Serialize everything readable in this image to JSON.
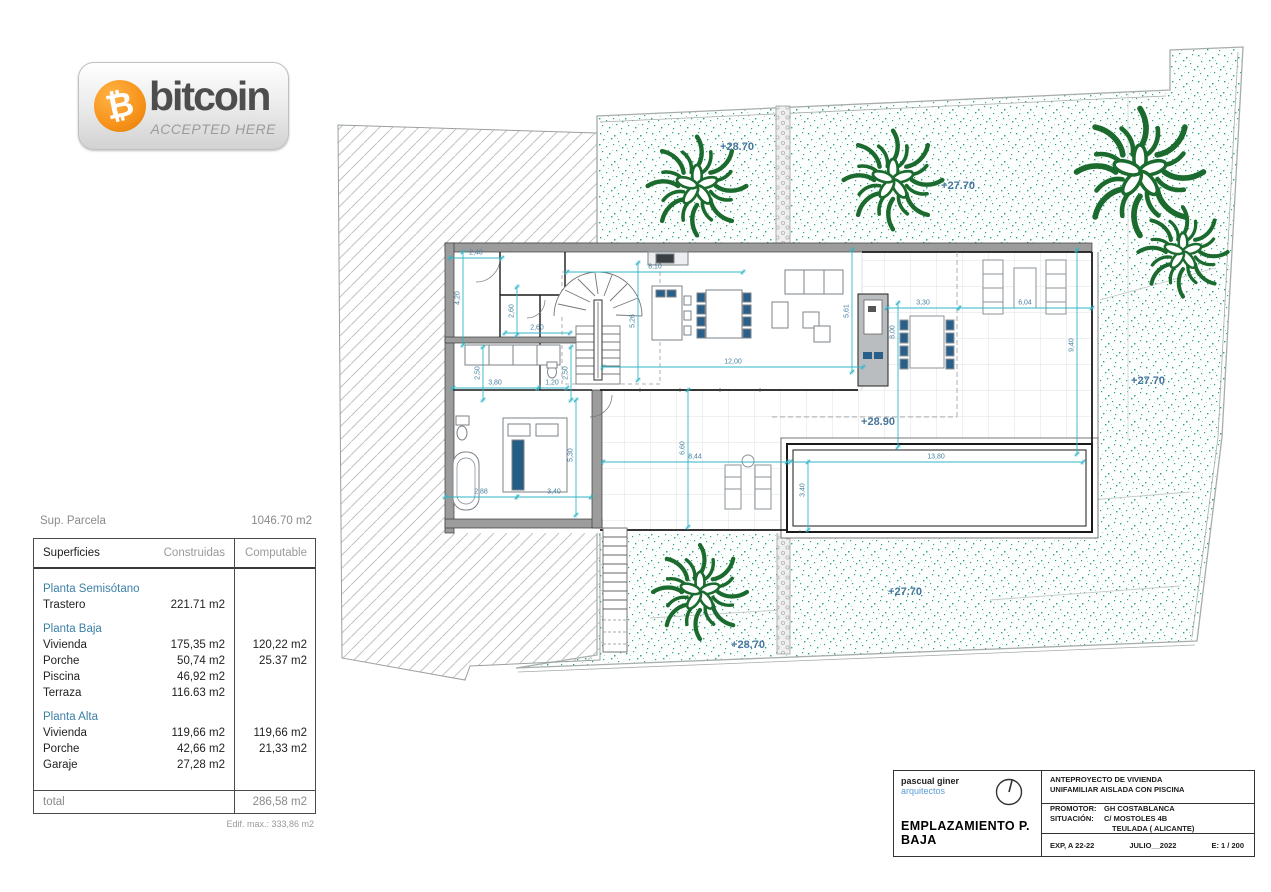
{
  "badge": {
    "symbol": "₿",
    "brand": "bitcoin",
    "tagline": "ACCEPTED HERE",
    "coin_color": "#f7931a"
  },
  "parcel_summary": {
    "label": "Sup. Parcela",
    "value": "1046.70 m2"
  },
  "area_table": {
    "headers": {
      "col1": "Superficies",
      "col2": "Construidas",
      "col3": "Computable"
    },
    "rows": [
      {
        "type": "section",
        "label": "Planta Semisótano",
        "built": "",
        "comp": ""
      },
      {
        "type": "item",
        "label": "Trastero",
        "built": "221.71 m2",
        "comp": ""
      },
      {
        "type": "section",
        "label": "Planta Baja",
        "built": "",
        "comp": ""
      },
      {
        "type": "item",
        "label": "Vivienda",
        "built": "175,35 m2",
        "comp": "120,22 m2"
      },
      {
        "type": "item",
        "label": "Porche",
        "built": "50,74 m2",
        "comp": "25.37 m2"
      },
      {
        "type": "item",
        "label": "Piscina",
        "built": "46,92 m2",
        "comp": ""
      },
      {
        "type": "item",
        "label": "Terraza",
        "built": "116.63 m2",
        "comp": ""
      },
      {
        "type": "section",
        "label": "Planta Alta",
        "built": "",
        "comp": ""
      },
      {
        "type": "item",
        "label": "Vivienda",
        "built": "119,66 m2",
        "comp": "119,66 m2"
      },
      {
        "type": "item",
        "label": "Porche",
        "built": "42,66 m2",
        "comp": "21,33 m2"
      },
      {
        "type": "item",
        "label": "Garaje",
        "built": "27,28 m2",
        "comp": ""
      }
    ],
    "total": {
      "label": "total",
      "value": "286,58 m2"
    },
    "footnote": "Edif. max.: 333,86 m2"
  },
  "plan": {
    "elevations": [
      {
        "text": "+28.70",
        "x": 737,
        "y": 147
      },
      {
        "text": "+27.70",
        "x": 958,
        "y": 186
      },
      {
        "text": "+27.70",
        "x": 1148,
        "y": 381
      },
      {
        "text": "+28.90",
        "x": 878,
        "y": 422
      },
      {
        "text": "+27.70",
        "x": 905,
        "y": 592
      },
      {
        "text": "+28.70",
        "x": 748,
        "y": 645
      }
    ],
    "dimensions": [
      {
        "text": "2,40",
        "x": 476,
        "y": 253,
        "rot": 0
      },
      {
        "text": "8,10",
        "x": 655,
        "y": 267,
        "rot": 0
      },
      {
        "text": "2,60",
        "x": 537,
        "y": 328,
        "rot": 0
      },
      {
        "text": "12,00",
        "x": 733,
        "y": 362,
        "rot": 0
      },
      {
        "text": "3,80",
        "x": 495,
        "y": 383,
        "rot": 0
      },
      {
        "text": "1,20",
        "x": 552,
        "y": 383,
        "rot": 0
      },
      {
        "text": "3,30",
        "x": 923,
        "y": 303,
        "rot": 0
      },
      {
        "text": "6,04",
        "x": 1025,
        "y": 303,
        "rot": 0
      },
      {
        "text": "8,44",
        "x": 695,
        "y": 457,
        "rot": 0
      },
      {
        "text": "13,80",
        "x": 936,
        "y": 457,
        "rot": 0
      },
      {
        "text": "2,88",
        "x": 481,
        "y": 492,
        "rot": 0
      },
      {
        "text": "3,40",
        "x": 554,
        "y": 492,
        "rot": 0
      },
      {
        "text": "4,20",
        "x": 458,
        "y": 298,
        "rot": 1
      },
      {
        "text": "2,60",
        "x": 512,
        "y": 311,
        "rot": 1
      },
      {
        "text": "5,26",
        "x": 633,
        "y": 321,
        "rot": 1
      },
      {
        "text": "2,50",
        "x": 478,
        "y": 373,
        "rot": 1
      },
      {
        "text": "2,50",
        "x": 566,
        "y": 373,
        "rot": 1
      },
      {
        "text": "5,61",
        "x": 847,
        "y": 311,
        "rot": 1
      },
      {
        "text": "8,00",
        "x": 893,
        "y": 332,
        "rot": 1
      },
      {
        "text": "9,40",
        "x": 1072,
        "y": 345,
        "rot": 1
      },
      {
        "text": "6,60",
        "x": 683,
        "y": 448,
        "rot": 1
      },
      {
        "text": "5,30",
        "x": 571,
        "y": 455,
        "rot": 1
      },
      {
        "text": "3,40",
        "x": 803,
        "y": 490,
        "rot": 1
      }
    ]
  },
  "title_block": {
    "firm_name": "pascual giner",
    "firm_type": "arquitectos",
    "drawing_title": "EMPLAZAMIENTO P. BAJA",
    "project_line1": "ANTEPROYECTO  DE VIVIENDA",
    "project_line2": "UNIFAMILIAR AISLADA CON PISCINA",
    "promotor_label": "PROMOTOR:",
    "promotor_value": "GH COSTABLANCA",
    "situacion_label": "SITUACIÓN:",
    "situacion_value1": "C/ MOSTOLES 4B",
    "situacion_value2": "TEULADA  ( ALICANTE)",
    "exp": "EXP, A 22-22",
    "date": "JULIO__2022",
    "scale": "E: 1 / 200"
  }
}
